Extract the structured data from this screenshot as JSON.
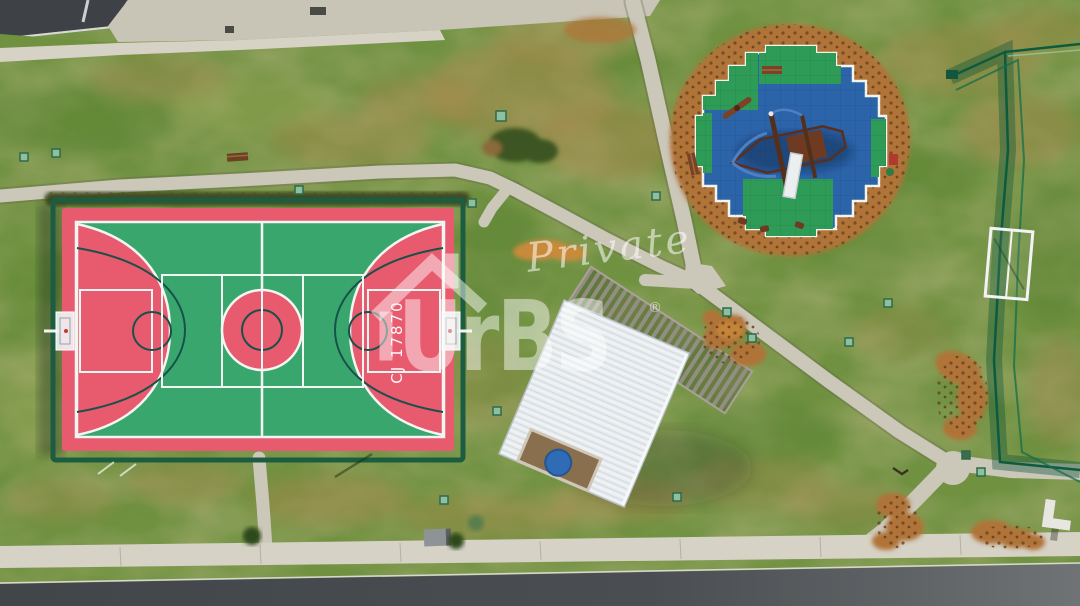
{
  "watermark": {
    "script_word": "Private",
    "brand_name": "UrBS",
    "registered_symbol": "®"
  },
  "court": {
    "painted_code": "CJ 17870"
  },
  "palette": {
    "grass_base": "#6f9140",
    "grass_dry_patch": "#a8874c",
    "court_red": "#e85a6e",
    "court_green": "#39a76d",
    "court_line_white": "#f2f5f2",
    "court_line_dark": "#17514a",
    "court_fence_green": "#1c5c40",
    "path_concrete": "#cbc7b9",
    "sidewalk_concrete": "#d6d2c5",
    "road_asphalt": "#45494d",
    "playground_tile_blue": "#2b64a9",
    "playground_tile_green": "#2e9c56",
    "mulch_brown": "#b07338",
    "pavilion_roof_white": "#e9edf0",
    "pergola_wood_gray": "#938d83",
    "round_table_blue": "#2f6cb5"
  }
}
